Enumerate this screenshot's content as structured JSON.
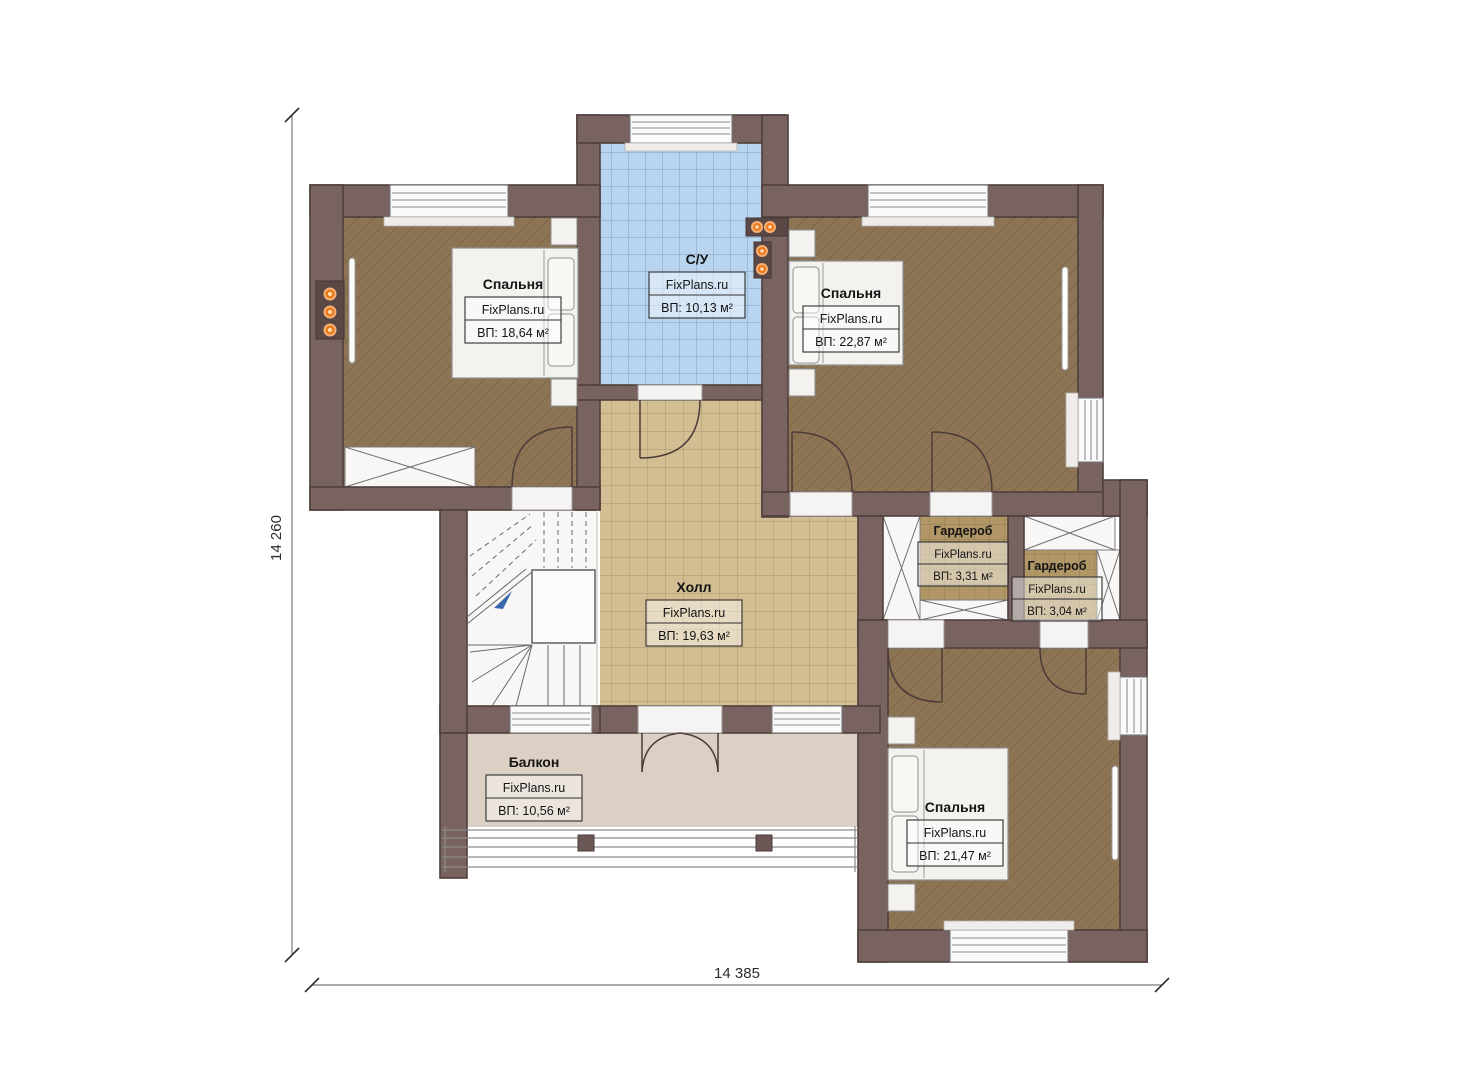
{
  "plan": {
    "title": "Second floor plan",
    "dimensions": {
      "left": "14 260",
      "bottom": "14 385"
    },
    "rooms": [
      {
        "id": "bedroom-top-left",
        "name": "Спальня",
        "brand": "FixPlans.ru",
        "area": "ВП: 18,64 м²"
      },
      {
        "id": "bathroom",
        "name": "С/У",
        "brand": "FixPlans.ru",
        "area": "ВП: 10,13 м²"
      },
      {
        "id": "bedroom-top-right",
        "name": "Спальня",
        "brand": "FixPlans.ru",
        "area": "ВП: 22,87 м²"
      },
      {
        "id": "hall",
        "name": "Холл",
        "brand": "FixPlans.ru",
        "area": "ВП: 19,63 м²"
      },
      {
        "id": "wardrobe-1",
        "name": "Гардероб",
        "brand": "FixPlans.ru",
        "area": "ВП: 3,31 м²"
      },
      {
        "id": "wardrobe-2",
        "name": "Гардероб",
        "brand": "FixPlans.ru",
        "area": "ВП: 3,04 м²"
      },
      {
        "id": "balcony",
        "name": "Балкон",
        "brand": "FixPlans.ru",
        "area": "ВП: 10,56 м²"
      },
      {
        "id": "bedroom-bottom-right",
        "name": "Спальня",
        "brand": "FixPlans.ru",
        "area": "ВП: 21,47 м²"
      }
    ],
    "colors": {
      "wall": "#786360",
      "bedroom_floor": "#8b7353",
      "hall_tile": "#d3bd92",
      "bath_tile": "#b9d4ef",
      "wardrobe_tile": "#b19766",
      "balcony_floor": "#dcd0c4",
      "light_dot": "#e87a1e"
    }
  }
}
